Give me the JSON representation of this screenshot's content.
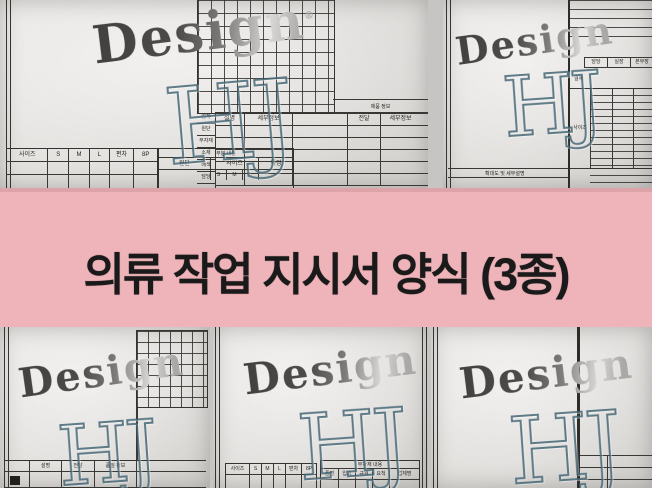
{
  "banner": {
    "title": "의류 작업 지시서 양식 (3종)",
    "bg_color": "#eeb4ba",
    "text_color": "#1b1a1a"
  },
  "watermark": {
    "brand": "Design",
    "reg": "®",
    "initials": "HJ"
  },
  "form_a": {
    "info_title": "제품 정보",
    "info_columns": [
      "설명",
      "세부정보",
      "전달",
      "세부정보"
    ],
    "row_labels": [
      "업체",
      "원단",
      "부자재",
      "소재",
      "배색",
      "담당"
    ],
    "size_headers": [
      "사이즈",
      "S",
      "M",
      "L",
      "편차",
      "8P"
    ],
    "detail_title": "부분 내용",
    "detail_cells": [
      "원단",
      "사이즈",
      "특징"
    ],
    "detail_sizes": [
      "S",
      "M",
      "L"
    ]
  },
  "form_b": {
    "approval_cells": [
      "담당",
      "실장",
      "본부장"
    ],
    "left_label": "결재",
    "panel_label": "사이즈",
    "footer_note": "확대도 및 세부설명"
  },
  "form_c": {
    "table_cells": [
      "설명",
      "전달"
    ],
    "table_title": "품질 정보"
  },
  "form_d": {
    "size_headers": [
      "사이즈",
      "S",
      "M",
      "L",
      "편차",
      "8P"
    ],
    "trim_title": "부자재 내용",
    "trim_columns": [
      "품명",
      "입고",
      "규격",
      "요척",
      "업체명"
    ]
  }
}
